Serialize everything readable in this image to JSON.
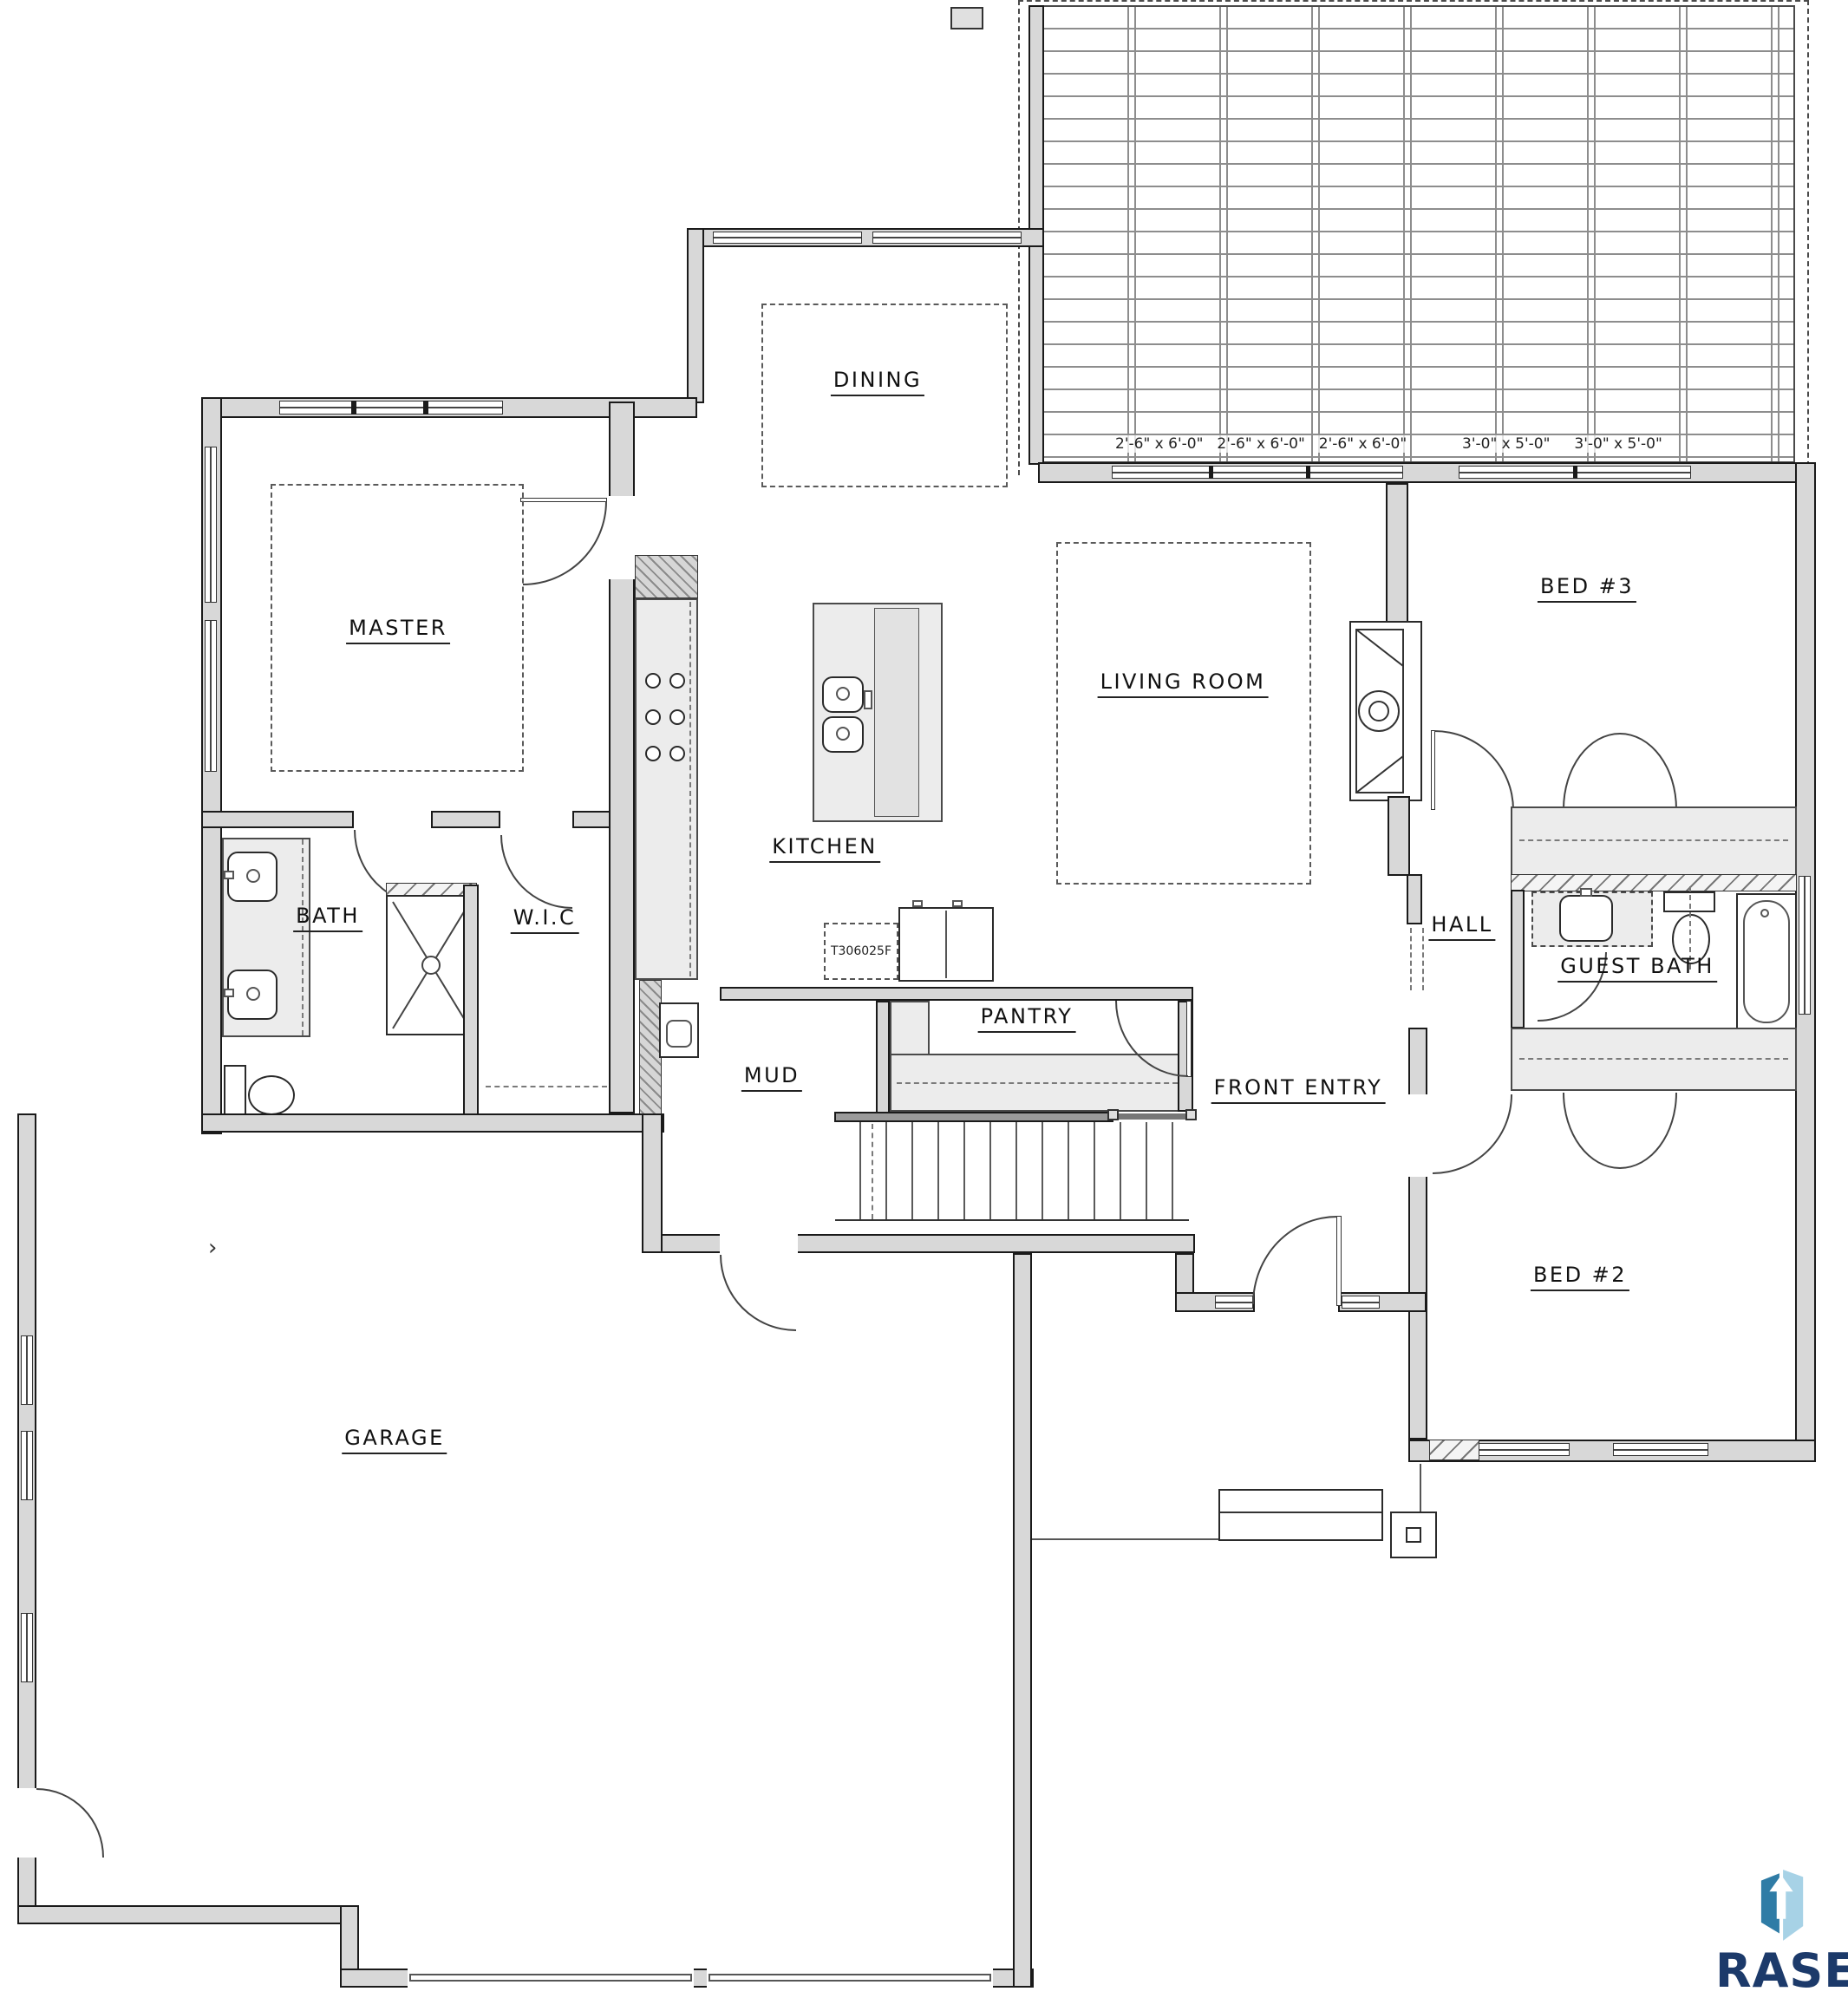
{
  "rooms": {
    "dining": "DINING",
    "master": "MASTER",
    "kitchen": "KITCHEN",
    "living_room": "LIVING ROOM",
    "bed3": "BED #3",
    "bath": "BATH",
    "wic": "W.I.C",
    "hall": "HALL",
    "guest_bath": "GUEST BATH",
    "pantry": "PANTRY",
    "mud": "MUD",
    "front_entry": "FRONT ENTRY",
    "bed2": "BED #2",
    "garage": "GARAGE"
  },
  "annotations": {
    "appliance_tag": "T306025F",
    "window_dims_left": [
      "2'-6\" x 6'-0\"",
      "2'-6\" x 6'-0\"",
      "2'-6\" x 6'-0\""
    ],
    "window_dims_right": [
      "3'-0\" x 5'-0\"",
      "3'-0\" x 5'-0\""
    ]
  },
  "logo": {
    "brand": "RASE",
    "colors": {
      "navy": "#1c3a6a",
      "steel_blue": "#2f7ca6",
      "light_blue": "#a7d2e6"
    }
  },
  "drawing": {
    "wall_fill": "#d8d8d8",
    "line_color": "#1a1a1a",
    "counter_fill": "#ececec"
  }
}
